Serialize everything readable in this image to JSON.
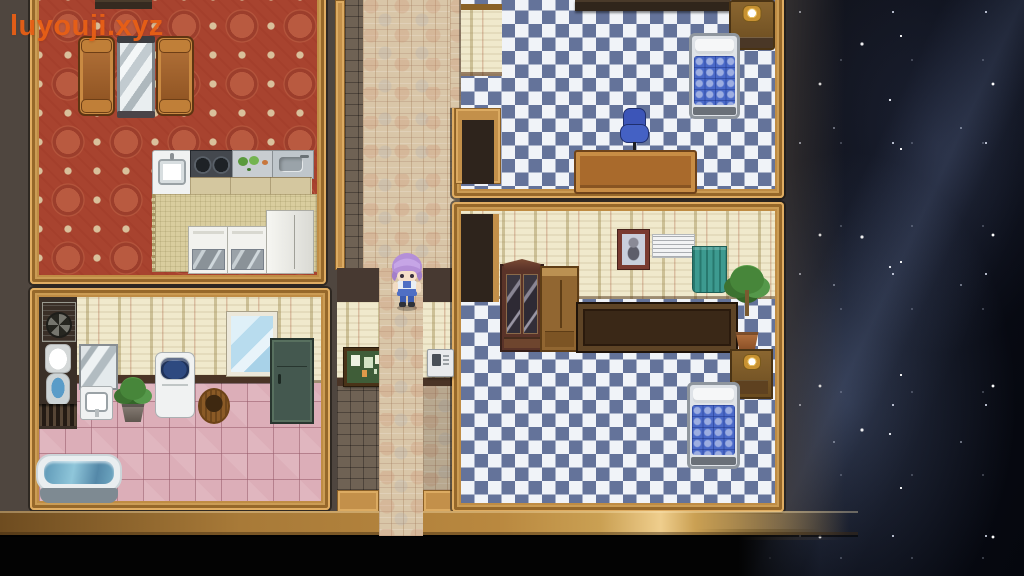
{
  "watermark": {
    "text": "luyouji.xyz"
  },
  "palette": {
    "watermark_orange": "#e85f15",
    "wall_brown": "#4f463f",
    "wood_trim": "#c3904a",
    "beam_highlight": "#efce8d",
    "checker_blue": "#64739a",
    "checker_white": "#f0f3f8",
    "carpet_red": "#a8432f",
    "tile_pink": "#dcaeb8",
    "brick_tan": "#d9c6a8",
    "wallpaper_cream": "#f0e9cc",
    "space_dark": "#06080f",
    "bed_blue": "#4a69c8",
    "curtain_teal": "#3d9a90"
  },
  "scene": {
    "description": "Top-down RPG Maker style house interior beside a starry night sky",
    "player": {
      "name": "purple-haired heroine",
      "facing": "down",
      "location": "central corridor junction"
    },
    "rooms": [
      {
        "name": "living room and kitchen",
        "position": "top-left",
        "floor": "red ornamental carpet",
        "items": [
          "sofa",
          "standing mirror",
          "sofa",
          "kitchen sink",
          "stove",
          "counter with vegetables",
          "second sink",
          "glass cabinets",
          "refrigerator",
          "kitchen mat"
        ]
      },
      {
        "name": "study bedroom",
        "position": "top-right",
        "floor": "blue diamond checker",
        "items": [
          "wall shelf",
          "mantel clock cabinet",
          "bed",
          "office chair",
          "desk",
          "doorway"
        ]
      },
      {
        "name": "bathroom",
        "position": "bottom-left",
        "floor": "pink tile",
        "items": [
          "air conditioner",
          "toilet",
          "floor grate",
          "wall mirror",
          "washbasin",
          "potted plant",
          "washing machine",
          "wicker basket",
          "window",
          "green locker",
          "bathtub"
        ]
      },
      {
        "name": "bedroom",
        "position": "bottom-right",
        "floor": "blue diamond checker",
        "items": [
          "display cabinet",
          "wardrobe",
          "portrait",
          "window blinds",
          "teal curtain",
          "long sideboard",
          "potted tree",
          "clock stand",
          "bed",
          "doorway"
        ]
      },
      {
        "name": "corridor",
        "position": "center",
        "floor": "herringbone brick",
        "items": [
          "bulletin board",
          "wall intercom",
          "south exit"
        ]
      }
    ]
  }
}
